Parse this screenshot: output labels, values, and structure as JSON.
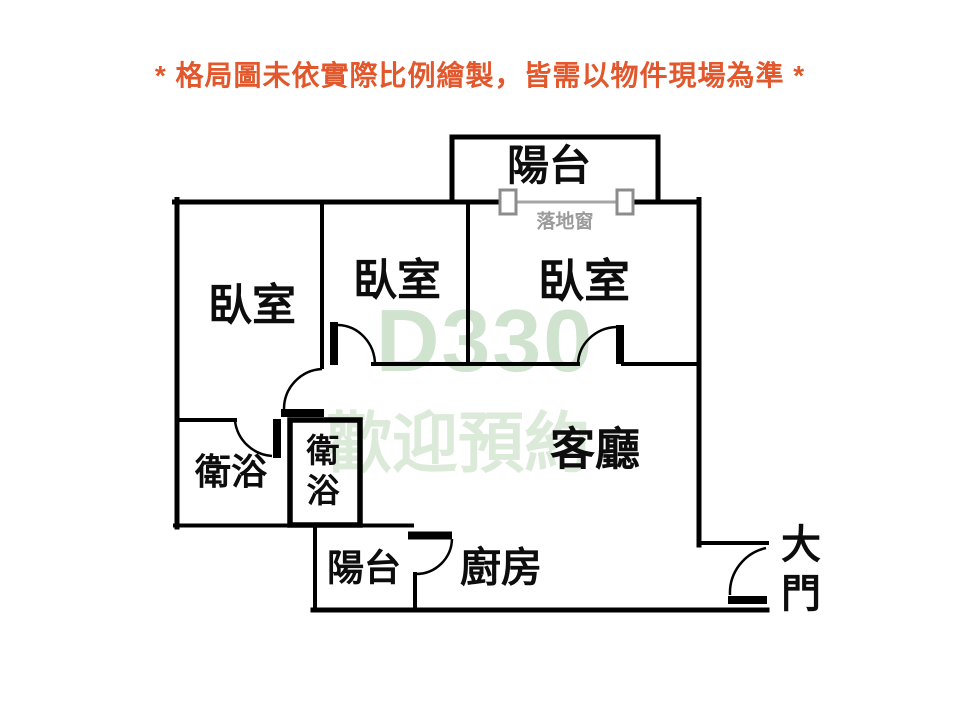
{
  "disclaimer": "* 格局圖未依實際比例繪製，皆需以物件現場為準 *",
  "watermark": {
    "line1": "D330",
    "line2": "歡迎預約"
  },
  "rooms": {
    "balcony_top": "陽台",
    "window_label": "落地窗",
    "bedroom_left": "臥室",
    "bedroom_middle": "臥室",
    "bedroom_right": "臥室",
    "living_room": "客廳",
    "bathroom_left": "衛浴",
    "bathroom_right": "衛浴",
    "balcony_bottom": "陽台",
    "kitchen": "廚房",
    "main_door": "大門"
  },
  "colors": {
    "accent": "#e2572b",
    "wall": "#000000",
    "watermark": "#cfe3cf",
    "watermark2": "#dcead9",
    "window_gray": "#9b9b9b"
  }
}
